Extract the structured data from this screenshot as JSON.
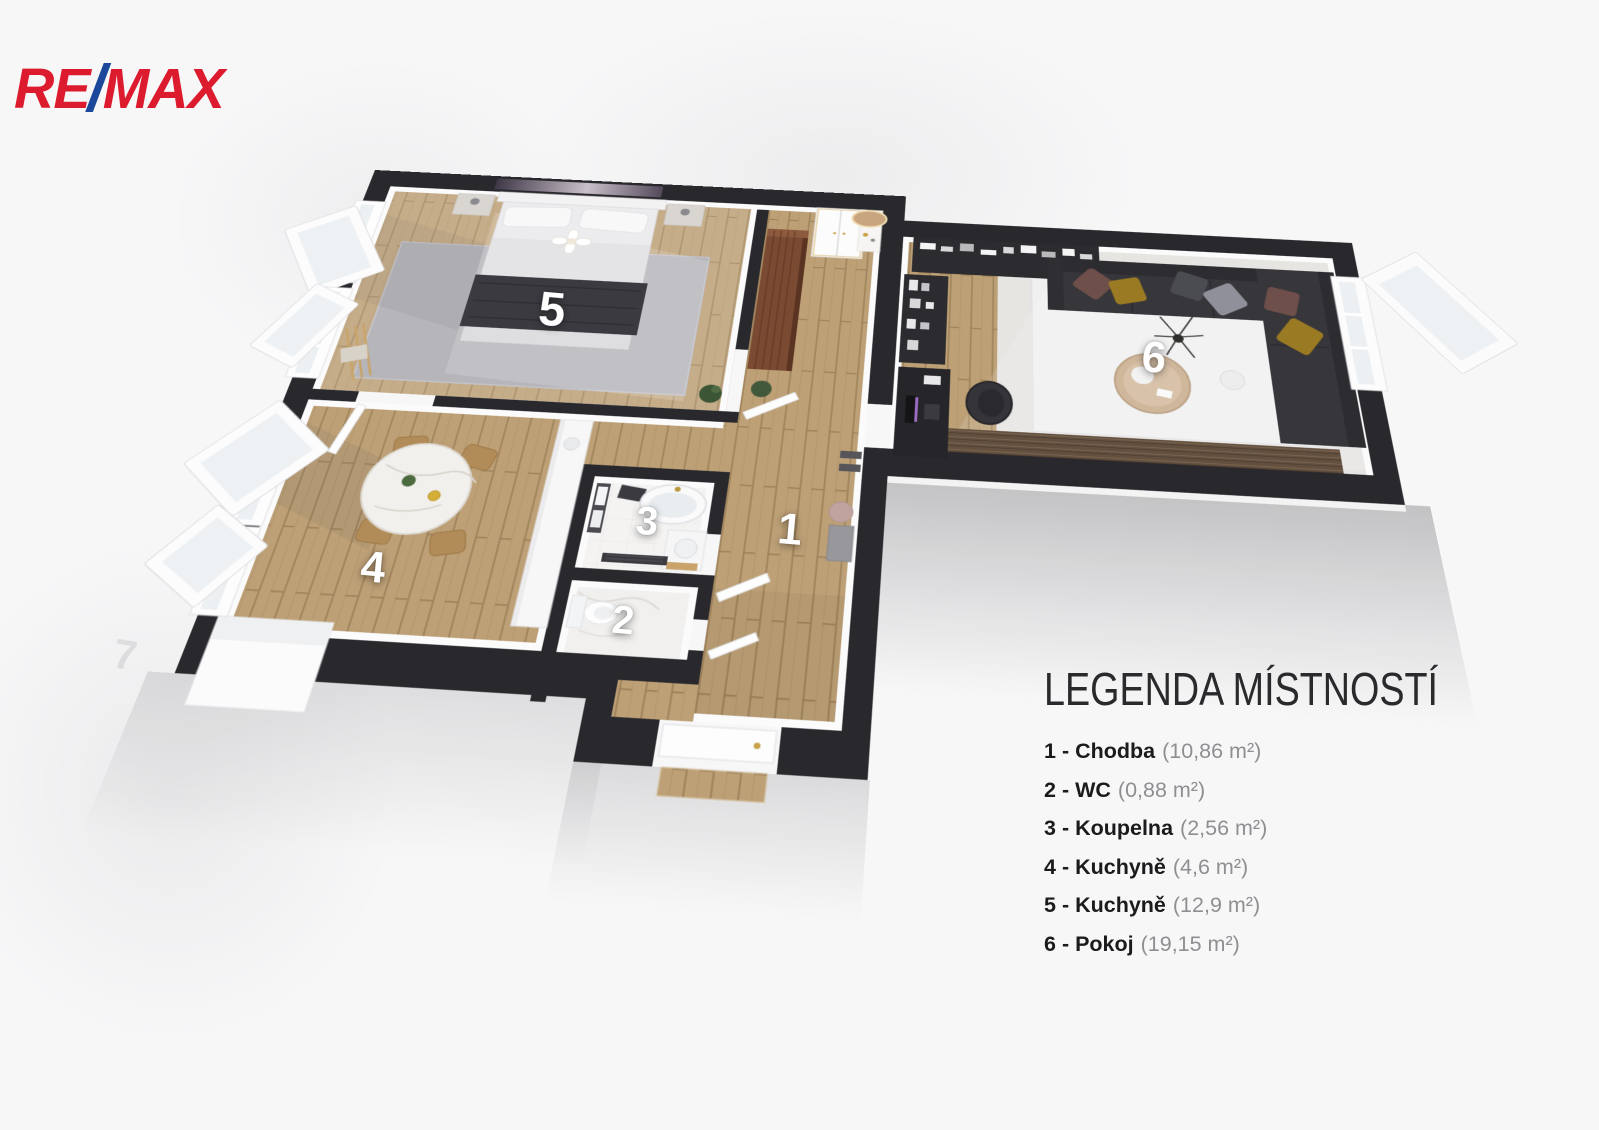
{
  "brand": {
    "logo_re": "RE",
    "logo_slash": "/",
    "logo_max": "MAX",
    "color_red": "#DC1C2E",
    "color_blue": "#1B489B"
  },
  "legend": {
    "title": "LEGENDA MÍSTNOSTÍ",
    "separator": " - ",
    "items": [
      {
        "number": "1",
        "name": "Chodba",
        "area": "(10,86 m²)"
      },
      {
        "number": "2",
        "name": "WC",
        "area": "(0,88 m²)"
      },
      {
        "number": "3",
        "name": "Koupelna",
        "area": "(2,56 m²)"
      },
      {
        "number": "4",
        "name": "Kuchyně",
        "area": "(4,6 m²)"
      },
      {
        "number": "5",
        "name": "Kuchyně",
        "area": "(12,9 m²)"
      },
      {
        "number": "6",
        "name": "Pokoj",
        "area": "(19,15 m²)"
      }
    ]
  },
  "floorplan": {
    "faint_digit": "7",
    "room_numbers": [
      "1",
      "2",
      "3",
      "4",
      "5",
      "6"
    ],
    "colors": {
      "wall": "#29292d",
      "wood_floor": "#bda076",
      "rug_gray": "#b5b5ba",
      "rug_white": "#f0f0f1",
      "tile": "#f4f3f2",
      "sofa": "#36363b",
      "wardrobe": "#7b4a33",
      "pillow_brown": "#6e4f49",
      "pillow_mustard": "#9a7a22",
      "table_marble": "#f2f0ec",
      "chair_tan": "#b28c58"
    }
  }
}
